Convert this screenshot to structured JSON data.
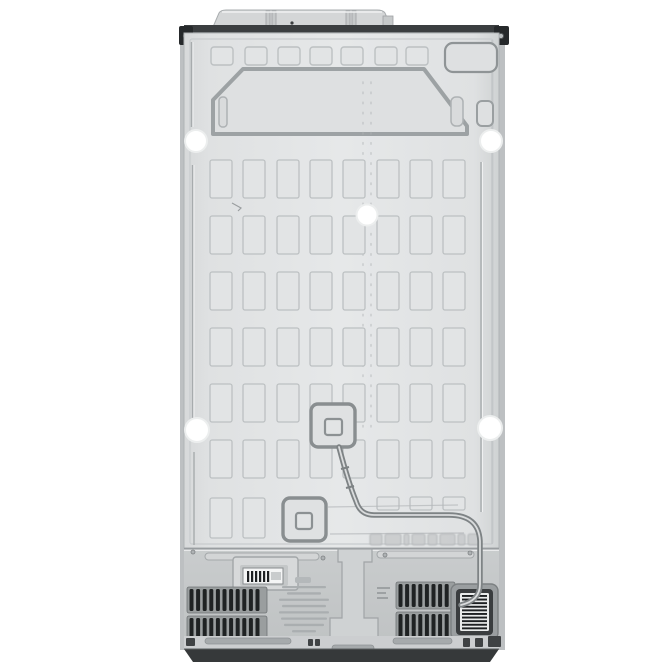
{
  "image": {
    "description": "Rear view product photo of a side-by-side refrigerator back panel on a white background",
    "background_color": "#ffffff"
  },
  "palette": {
    "panel_light": "#e6e8e9",
    "panel_mid": "#dfe1e2",
    "panel_dark_edge": "#cfd2d3",
    "emboss_stroke": "#bcc0c2",
    "cell_fill": "#e2e4e5",
    "top_strip": "#3b3e40",
    "base": "#36393a",
    "compartment_top": "#c9cccd",
    "compartment_bottom": "#bfc2c3",
    "vent_bg": "#9a9e9f",
    "vent_slot": "#1f2223",
    "hole": "#ffffff",
    "barcode_ink": "#1d2022",
    "fineprint_ink": "#a9adaf",
    "emboss_marking_fill": "#c8cbcc"
  },
  "grid": {
    "cols": [
      210,
      243,
      277,
      310,
      343,
      377,
      410,
      443
    ],
    "cell_w": 22,
    "rows": [
      160,
      216,
      272,
      328,
      384,
      440
    ],
    "cell_h": 38,
    "extras": [
      {
        "x": 210,
        "y": 498,
        "w": 22,
        "h": 40
      },
      {
        "x": 243,
        "y": 498,
        "w": 22,
        "h": 40
      },
      {
        "x": 377,
        "y": 497,
        "w": 22,
        "h": 13
      },
      {
        "x": 410,
        "y": 497,
        "w": 22,
        "h": 13
      },
      {
        "x": 443,
        "y": 497,
        "w": 22,
        "h": 13
      }
    ]
  },
  "top_squares": {
    "xs": [
      211,
      245,
      278,
      310,
      341,
      375,
      406
    ],
    "y": 47,
    "w": 22,
    "h": 18
  },
  "holes": [
    {
      "cx": 196,
      "cy": 141,
      "r": 11
    },
    {
      "cx": 491,
      "cy": 141,
      "r": 11
    },
    {
      "cx": 367,
      "cy": 215,
      "r": 10.5
    },
    {
      "cx": 197,
      "cy": 430,
      "r": 12
    },
    {
      "cx": 490,
      "cy": 428,
      "r": 12
    }
  ],
  "vents": {
    "left": {
      "x": 187,
      "w": 80,
      "bands": [
        {
          "y": 587,
          "h": 26
        },
        {
          "y": 616,
          "h": 28
        }
      ],
      "slot_w": 4,
      "pitch": 6.6
    },
    "right": {
      "x": 396,
      "w": 59,
      "bands": [
        {
          "y": 582,
          "h": 27
        },
        {
          "y": 612,
          "h": 30
        }
      ],
      "slot_w": 4,
      "pitch": 6.6
    }
  },
  "barcode_left": {
    "x": 247,
    "y": 571,
    "h": 11,
    "bar_w": 2.2,
    "pitch": 4,
    "count": 6
  },
  "barcode_right": {
    "x": 462,
    "y": 595,
    "w": 25,
    "bar_h": 1.9,
    "pitch": 3.6,
    "count": 10
  },
  "fineprint": {
    "cx": 304,
    "y": 586,
    "dy": 6.3,
    "h": 2.3,
    "widths": [
      44,
      34,
      50,
      44,
      50,
      46,
      40,
      24,
      14
    ]
  },
  "bracket_marks": {
    "x": 377,
    "y": 587,
    "dy": 5,
    "h": 2,
    "widths": [
      13,
      9,
      11
    ]
  },
  "emboss_marking": {
    "x": 370,
    "y": 534,
    "h": 11,
    "gap": 3,
    "widths": [
      12,
      16,
      5,
      13,
      9,
      15,
      7,
      11
    ]
  },
  "dotted_lines": {
    "xs": [
      363,
      371
    ],
    "y1": 82,
    "y2": 428
  }
}
